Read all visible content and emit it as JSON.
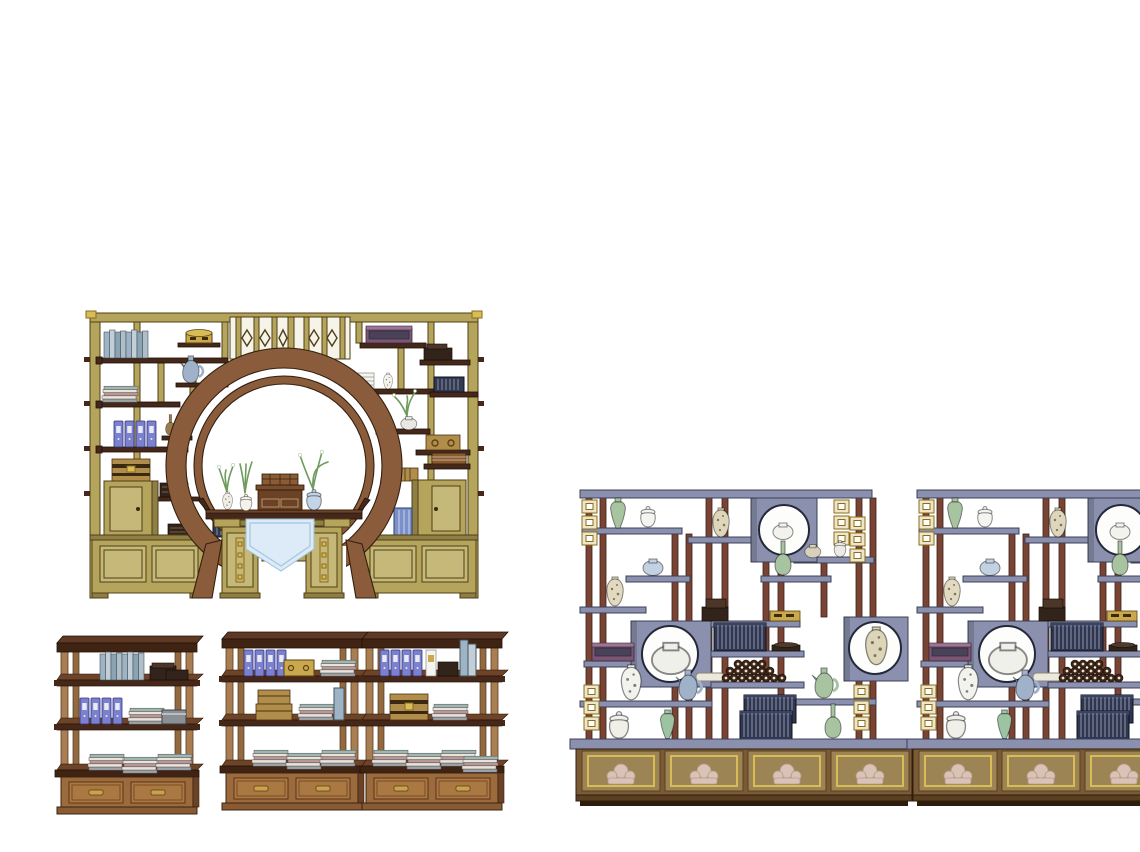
{
  "watermark": {
    "cn": "素模网",
    "en": "suuuum.com"
  },
  "palette": {
    "khaki": "#b5a45c",
    "khaki-dark": "#8f7f45",
    "khaki-light": "#c6b878",
    "khaki-line": "#4f3f16",
    "darkwood": "#46281a",
    "darkwood-top": "#6e4429",
    "arch": "#8a5c3c",
    "arch-line": "#33200f",
    "shelfblue": "#8a90ad",
    "shelfblue-line": "#3c4057",
    "postred": "#7a4434",
    "postred-line": "#3a1f14",
    "gold": "#d8bc55",
    "gold-line": "#8a6d1d",
    "cab-brown": "#7c5a36",
    "cab-panel": "#9c8455",
    "motif": "#d9c3b6",
    "book-navy": "#2e3650",
    "binder": "#7b80cf",
    "celadon": "#a8c3a0",
    "cloth": "#dcebf7",
    "rack-wood": "#a87e52",
    "rack-dark": "#3f2414",
    "drawer": "#a97843",
    "white-porcelain": "#f2f2ee",
    "cream": "#ded6ba",
    "blue-porcelain": "#c2d4e6",
    "watermark-fill": "#ffffff",
    "watermark-stroke": "#c4c4c4"
  },
  "scene": {
    "background": "#ffffff",
    "furniture": [
      {
        "id": "moon-gate-bookcase",
        "label": "Moon-gate wall bookcase with writing desk"
      },
      {
        "id": "book-rack-1",
        "label": "Three-tier book rack with drawers"
      },
      {
        "id": "book-rack-2",
        "label": "Three-tier book rack with drawers"
      },
      {
        "id": "book-rack-3",
        "label": "Three-tier book rack with drawers"
      },
      {
        "id": "curio-shelf-1",
        "label": "Duobaoge curio display shelf with base cabinet"
      },
      {
        "id": "curio-shelf-2",
        "label": "Duobaoge curio display shelf with base cabinet (cropped)"
      }
    ]
  }
}
